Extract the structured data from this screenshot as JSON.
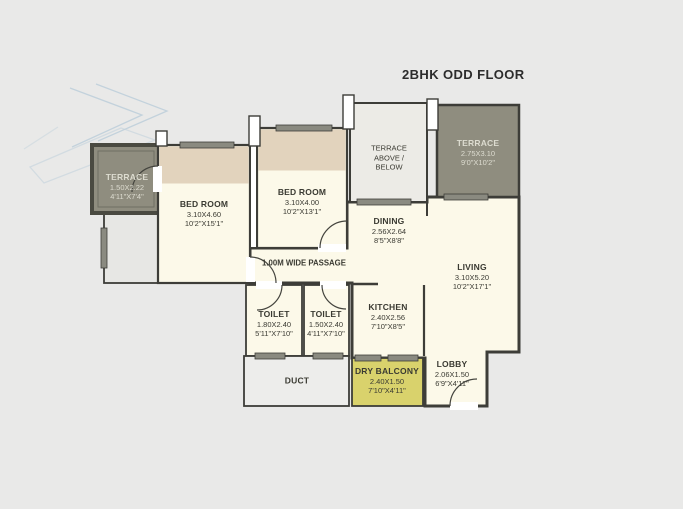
{
  "title": "2BHK ODD FLOOR",
  "colors": {
    "background": "#e9e9e8",
    "room_fill": "#fcf9e9",
    "wardrobe_band": "#e2d3bd",
    "terrace_fill": "#8f8d7f",
    "terrace_above_fill": "#ecebe6",
    "dry_balcony_fill": "#d9d26c",
    "duct_fill": "#ededeb",
    "wall": "#3d3d38",
    "window_fill": "#8a8a80",
    "light_label": "#dddcd0",
    "dark_label": "#3a3a32",
    "watermark": "#b7cbd9"
  },
  "rooms": [
    {
      "id": "terrace-left",
      "name": "TERRACE",
      "dim_m": "1.50X2.22",
      "dim_ft": "4'11\"X7'4\""
    },
    {
      "id": "bedroom-1",
      "name": "BED ROOM",
      "dim_m": "3.10X4.60",
      "dim_ft": "10'2\"X15'1\""
    },
    {
      "id": "bedroom-2",
      "name": "BED ROOM",
      "dim_m": "3.10X4.00",
      "dim_ft": "10'2\"X13'1\""
    },
    {
      "id": "terrace-above-below",
      "name": "TERRACE",
      "line2": "ABOVE /",
      "line3": "BELOW"
    },
    {
      "id": "terrace-right",
      "name": "TERRACE",
      "dim_m": "2.75X3.10",
      "dim_ft": "9'0\"X10'2\""
    },
    {
      "id": "dining",
      "name": "DINING",
      "dim_m": "2.56X2.64",
      "dim_ft": "8'5\"X8'8\""
    },
    {
      "id": "living",
      "name": "LIVING",
      "dim_m": "3.10X5.20",
      "dim_ft": "10'2\"X17'1\""
    },
    {
      "id": "passage",
      "name": "1.00M WIDE PASSAGE"
    },
    {
      "id": "toilet-1",
      "name": "TOILET",
      "dim_m": "1.80X2.40",
      "dim_ft": "5'11\"X7'10\""
    },
    {
      "id": "toilet-2",
      "name": "TOILET",
      "dim_m": "1.50X2.40",
      "dim_ft": "4'11\"X7'10\""
    },
    {
      "id": "kitchen",
      "name": "KITCHEN",
      "dim_m": "2.40X2.56",
      "dim_ft": "7'10\"X8'5\""
    },
    {
      "id": "duct",
      "name": "DUCT"
    },
    {
      "id": "dry-balcony",
      "name": "DRY BALCONY",
      "dim_m": "2.40X1.50",
      "dim_ft": "7'10\"X4'11\""
    },
    {
      "id": "lobby",
      "name": "LOBBY",
      "dim_m": "2.06X1.50",
      "dim_ft": "6'9\"X4'11\""
    }
  ]
}
